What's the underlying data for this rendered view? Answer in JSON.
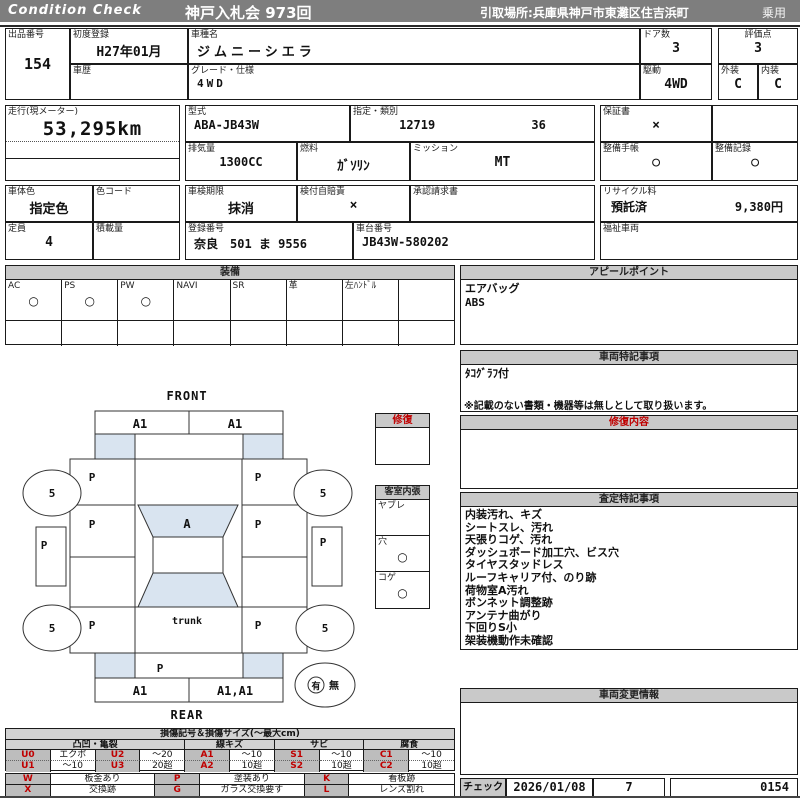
{
  "header": {
    "brand": "Condition  Check",
    "auction": "神戸入札会  973回",
    "pickup": "引取場所:兵庫県神戸市東灘区住吉浜町",
    "vehicle_class": "乗用"
  },
  "info": {
    "lot_label": "出品番号",
    "lot_no": "154",
    "first_reg_label": "初度登録",
    "first_reg": "H27年01月",
    "history_label": "車歴",
    "history": "",
    "model_name_label": "車種名",
    "model_name": "ジムニーシエラ",
    "grade_label": "グレード・仕様",
    "grade": "4WD",
    "doors_label": "ドア数",
    "doors": "3",
    "drive_label": "駆動",
    "drive": "4WD",
    "score_label": "評価点",
    "score": "3",
    "exterior_label": "外装",
    "exterior": "C",
    "interior_label": "内装",
    "interior": "C",
    "mileage_label": "走行(現メーター)",
    "mileage": "53,295km",
    "model_code_label": "型式",
    "model_code": "ABA-JB43W",
    "type_label": "指定・類別",
    "type_no1": "12719",
    "type_no2": "36",
    "displacement_label": "排気量",
    "displacement": "1300CC",
    "fuel_label": "燃料",
    "fuel": "ｶﾞｿﾘﾝ",
    "transmission_label": "ミッション",
    "transmission": "MT",
    "warranty_label": "保証書",
    "warranty": "×",
    "maintenance_book_label": "整備手帳",
    "maintenance_book": "○",
    "maintenance_record_label": "整備記録",
    "maintenance_record": "○",
    "body_color_label": "車体色",
    "body_color": "指定色",
    "color_code_label": "色コード",
    "color_code": "",
    "inspection_label": "車検期限",
    "inspection": "抹消",
    "insurance_label": "検付自賠責",
    "insurance": "×",
    "approval_label": "承認請求書",
    "approval": "",
    "recycle_label": "リサイクル料",
    "recycle_status": "預託済",
    "recycle_fee": "9,380円",
    "capacity_label": "定員",
    "capacity": "4",
    "load_label": "積載量",
    "load": "",
    "reg_no_label": "登録番号",
    "reg_no": "奈良　501 ま  9556",
    "chassis_label": "車台番号",
    "chassis_no": "JB43W-580202",
    "welfare_label": "福祉車両",
    "welfare": ""
  },
  "equipment": {
    "title": "装備",
    "items": [
      {
        "label": "AC",
        "value": "○"
      },
      {
        "label": "PS",
        "value": "○"
      },
      {
        "label": "PW",
        "value": "○"
      },
      {
        "label": "NAVI",
        "value": ""
      },
      {
        "label": "SR",
        "value": ""
      },
      {
        "label": "革",
        "value": ""
      },
      {
        "label": "左ﾊﾝﾄﾞﾙ",
        "value": ""
      },
      {
        "label": "",
        "value": ""
      }
    ]
  },
  "appeal": {
    "title": "アピールポイント",
    "lines": [
      "エアバッグ",
      "ABS"
    ]
  },
  "vehicle_notes": {
    "title": "車両特記事項",
    "lines": [
      "ﾀｺｸﾞﾗﾌ付"
    ],
    "disclaimer": "※記載のない書類・機器等は無しとして取り扱います。"
  },
  "repair_content": {
    "title": "修復内容",
    "content": ""
  },
  "assessment": {
    "title": "査定特記事項",
    "lines": [
      "内装汚れ、キズ",
      "シートスレ、汚れ",
      "天張りコゲ、汚れ",
      "ダッシュボード加工穴、ビス穴",
      "タイヤスタッドレス",
      "ルーフキャリア付、のり跡",
      "荷物室A汚れ",
      "ボンネット調整跡",
      "アンテナ曲がり",
      "下回りS小",
      "架装機動作未確認"
    ]
  },
  "change_info": {
    "title": "車両変更情報",
    "content": ""
  },
  "check": {
    "label": "チェック",
    "date": "2026/01/08",
    "inspector": "7",
    "serial": "0154"
  },
  "repair_box": {
    "title": "修復",
    "content": ""
  },
  "interior_box": {
    "title": "客室内張",
    "items": [
      {
        "label": "ヤブレ",
        "value": ""
      },
      {
        "label": "穴",
        "value": "○"
      },
      {
        "label": "コゲ",
        "value": "○"
      }
    ]
  },
  "diagram": {
    "front": "FRONT",
    "rear": "REAR",
    "front_bumper_left": "A1",
    "front_bumper_right": "A1",
    "hood_left": "P",
    "hood_right": "P",
    "door_left": "P",
    "door_right": "P",
    "windshield": "A",
    "trunk": "trunk",
    "quarter_left": "P",
    "quarter_right": "P",
    "rear_panel": "P",
    "rear_bumper_left": "A1",
    "rear_bumper_right": "A1,A1",
    "wheel_fl": "5",
    "wheel_fr": "5",
    "wheel_rl": "5",
    "wheel_rr": "5",
    "side_left": "P",
    "side_right": "P",
    "presence_yes": "有",
    "presence_no": "無"
  },
  "legend": {
    "title": "損傷記号＆損傷サイズ(～最大cm)",
    "groups": [
      "凸凹・亀裂",
      "線キズ",
      "サビ",
      "腐食"
    ],
    "rows": [
      [
        "U0",
        "エクボ",
        "U2",
        "～20",
        "A1",
        "～10",
        "S1",
        "～10",
        "C1",
        "～10"
      ],
      [
        "U1",
        "～10",
        "U3",
        "20超",
        "A2",
        "10超",
        "S2",
        "10超",
        "C2",
        "10超"
      ]
    ],
    "codes2": [
      [
        "W",
        "板金あり",
        "P",
        "塗装あり",
        "K",
        "看板跡"
      ],
      [
        "X",
        "交換跡",
        "G",
        "ガラス交換要す",
        "L",
        "レンズ割れ"
      ]
    ]
  },
  "colors": {
    "header_gray": "#7e7e7e",
    "band_gray": "#c9c9c9",
    "accent_red": "#c00000",
    "diagram_blue": "#2222bb",
    "shade_blue": "#d9e4f0"
  }
}
